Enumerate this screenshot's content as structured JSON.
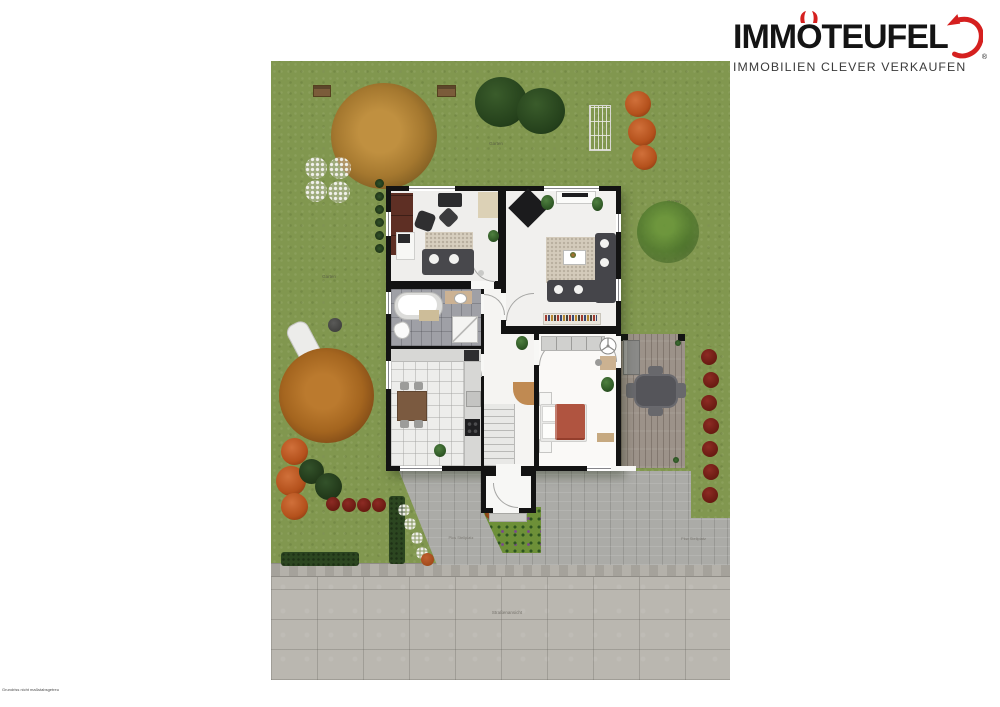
{
  "logo": {
    "brand_pre": "IMM",
    "brand_o": "O",
    "brand_post": "TEUFEL",
    "registered": "®",
    "tagline": "IMMOBILIEN CLEVER VERKAUFEN",
    "accent_color": "#d5201f",
    "text_color": "#141414"
  },
  "plan": {
    "garden_labels": [
      {
        "text": "Garten"
      },
      {
        "text": "Garten"
      },
      {
        "text": "Garten"
      }
    ],
    "street_label": "Straßenansicht",
    "parking_labels": [
      {
        "text": "Pkw Stellplatz"
      },
      {
        "text": "Pkw Stellplatz"
      }
    ],
    "colors": {
      "grass": "#81974f",
      "street": "#bab7b0",
      "driveway": "#ababa7",
      "deck": "#9c9289",
      "walls": "#131313",
      "autumn_tree": "#a9772f",
      "evergreen_tree": "#24401b",
      "orange_bush": "#b4511c",
      "red_bush": "#6f1d1d",
      "hedge": "#2c4620"
    }
  },
  "footer": {
    "disclaimer": "Grundriss nicht maßstabsgetreu"
  }
}
